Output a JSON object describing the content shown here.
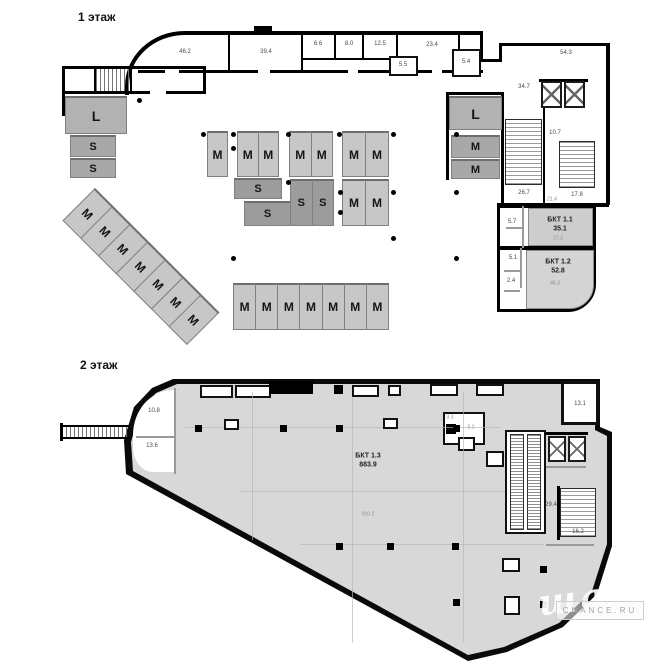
{
  "colors": {
    "wall": "#000000",
    "floor_fill": "#d8d8d8",
    "m_unit": "#c7c7c7",
    "s_unit": "#a8a8a8",
    "l_unit": "#b2b2b2",
    "dark_unit": "#9c9c9c"
  },
  "unit_labels": {
    "M": "M",
    "S": "S",
    "L": "L"
  },
  "floor1": {
    "title": "1 этаж",
    "rooms": {
      "a462": "46.2",
      "a394": "39.4",
      "a66": "6.6",
      "a80": "8.0",
      "a125": "12.5",
      "a234": "23.4",
      "a55": "5.5",
      "a54": "5.4",
      "a543": "54.3",
      "a347": "34.7",
      "a107": "10.7",
      "a267": "26.7",
      "a178": "17.8",
      "a214": "21.4",
      "a57": "5.7",
      "a51": "5.1",
      "a24": "2.4"
    },
    "bkt11": {
      "name": "БКТ 1.1",
      "area": "35.1",
      "sub": "27.3"
    },
    "bkt12": {
      "name": "БКТ 1.2",
      "area": "52.8",
      "sub": "46.3"
    }
  },
  "floor2": {
    "title": "2 этаж",
    "rooms": {
      "a108": "10.8",
      "a136": "13.6",
      "a131": "13.1",
      "a52": "5.2",
      "a33": "3.3",
      "a294": "29.4",
      "a162": "16.2",
      "a9102": "910.2"
    },
    "bkt13": {
      "name": "БКТ 1.3",
      "area": "883.9"
    }
  },
  "watermark": {
    "script": "шанс",
    "site": "CHANCE.RU"
  }
}
